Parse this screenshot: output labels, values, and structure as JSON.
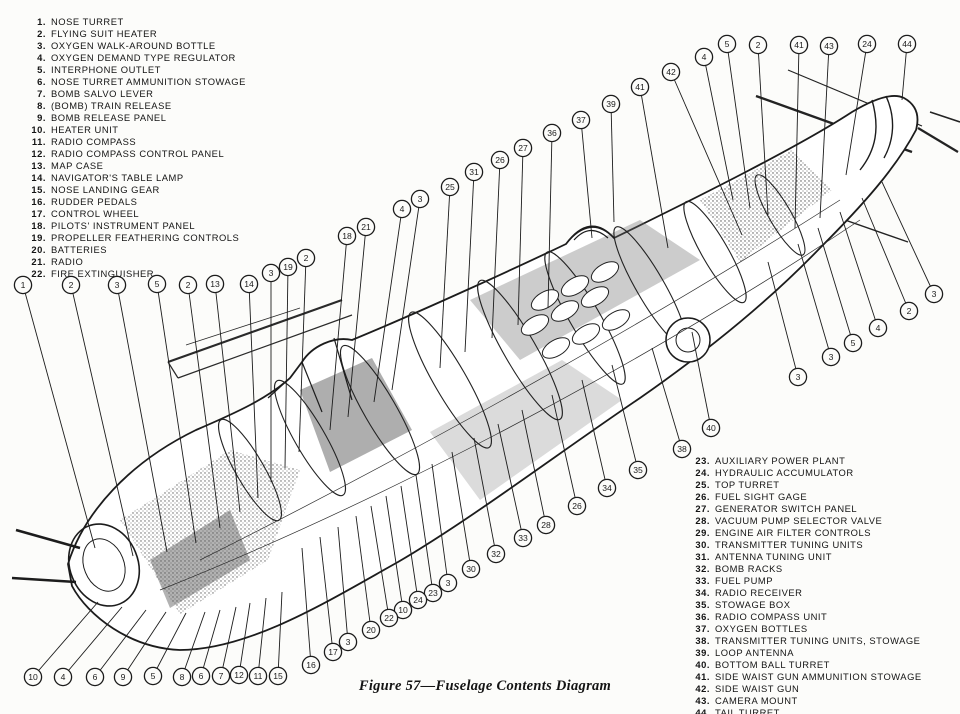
{
  "figure": {
    "caption": "Figure 57—Fuselage Contents Diagram"
  },
  "colors": {
    "ink": "#1c1c1c",
    "paper": "#fcfcfa",
    "shade": "#5d5d5d"
  },
  "legend_left": [
    {
      "num": "1.",
      "label": "NOSE TURRET"
    },
    {
      "num": "2.",
      "label": "FLYING SUIT HEATER"
    },
    {
      "num": "3.",
      "label": "OXYGEN WALK-AROUND BOTTLE"
    },
    {
      "num": "4.",
      "label": "OXYGEN DEMAND TYPE REGULATOR"
    },
    {
      "num": "5.",
      "label": "INTERPHONE OUTLET"
    },
    {
      "num": "6.",
      "label": "NOSE TURRET AMMUNITION STOWAGE"
    },
    {
      "num": "7.",
      "label": "BOMB SALVO LEVER"
    },
    {
      "num": "8.",
      "label": "(BOMB) TRAIN RELEASE"
    },
    {
      "num": "9.",
      "label": "BOMB RELEASE PANEL"
    },
    {
      "num": "10.",
      "label": "HEATER UNIT"
    },
    {
      "num": "11.",
      "label": "RADIO COMPASS"
    },
    {
      "num": "12.",
      "label": "RADIO COMPASS CONTROL PANEL"
    },
    {
      "num": "13.",
      "label": "MAP CASE"
    },
    {
      "num": "14.",
      "label": "NAVIGATOR'S TABLE LAMP"
    },
    {
      "num": "15.",
      "label": "NOSE LANDING GEAR"
    },
    {
      "num": "16.",
      "label": "RUDDER PEDALS"
    },
    {
      "num": "17.",
      "label": "CONTROL WHEEL"
    },
    {
      "num": "18.",
      "label": "PILOTS' INSTRUMENT PANEL"
    },
    {
      "num": "19.",
      "label": "PROPELLER FEATHERING CONTROLS"
    },
    {
      "num": "20.",
      "label": "BATTERIES"
    },
    {
      "num": "21.",
      "label": "RADIO"
    },
    {
      "num": "22.",
      "label": "FIRE EXTINGUISHER"
    }
  ],
  "legend_right": [
    {
      "num": "23.",
      "label": "AUXILIARY POWER PLANT"
    },
    {
      "num": "24.",
      "label": "HYDRAULIC ACCUMULATOR"
    },
    {
      "num": "25.",
      "label": "TOP TURRET"
    },
    {
      "num": "26.",
      "label": "FUEL SIGHT GAGE"
    },
    {
      "num": "27.",
      "label": "GENERATOR SWITCH PANEL"
    },
    {
      "num": "28.",
      "label": "VACUUM PUMP SELECTOR VALVE"
    },
    {
      "num": "29.",
      "label": "ENGINE AIR FILTER CONTROLS"
    },
    {
      "num": "30.",
      "label": "TRANSMITTER TUNING UNITS"
    },
    {
      "num": "31.",
      "label": "ANTENNA TUNING UNIT"
    },
    {
      "num": "32.",
      "label": "BOMB RACKS"
    },
    {
      "num": "33.",
      "label": "FUEL PUMP"
    },
    {
      "num": "34.",
      "label": "RADIO RECEIVER"
    },
    {
      "num": "35.",
      "label": "STOWAGE BOX"
    },
    {
      "num": "36.",
      "label": "RADIO COMPASS UNIT"
    },
    {
      "num": "37.",
      "label": "OXYGEN BOTTLES"
    },
    {
      "num": "38.",
      "label": "TRANSMITTER TUNING UNITS, STOWAGE"
    },
    {
      "num": "39.",
      "label": "LOOP ANTENNA"
    },
    {
      "num": "40.",
      "label": "BOTTOM BALL TURRET"
    },
    {
      "num": "41.",
      "label": "SIDE WAIST GUN AMMUNITION STOWAGE"
    },
    {
      "num": "42.",
      "label": "SIDE WAIST GUN"
    },
    {
      "num": "43.",
      "label": "CAMERA MOUNT"
    },
    {
      "num": "44.",
      "label": "TAIL TURRET"
    }
  ],
  "callouts": [
    {
      "n": "1",
      "x": 23,
      "y": 285,
      "tx": 95,
      "ty": 548
    },
    {
      "n": "2",
      "x": 71,
      "y": 285,
      "tx": 133,
      "ty": 556
    },
    {
      "n": "3",
      "x": 117,
      "y": 285,
      "tx": 167,
      "ty": 552
    },
    {
      "n": "5",
      "x": 157,
      "y": 284,
      "tx": 196,
      "ty": 543
    },
    {
      "n": "2",
      "x": 188,
      "y": 285,
      "tx": 220,
      "ty": 528
    },
    {
      "n": "13",
      "x": 215,
      "y": 284,
      "tx": 240,
      "ty": 512
    },
    {
      "n": "14",
      "x": 249,
      "y": 284,
      "tx": 258,
      "ty": 498
    },
    {
      "n": "3",
      "x": 271,
      "y": 273,
      "tx": 271,
      "ty": 482
    },
    {
      "n": "19",
      "x": 288,
      "y": 267,
      "tx": 285,
      "ty": 468
    },
    {
      "n": "2",
      "x": 306,
      "y": 258,
      "tx": 299,
      "ty": 452
    },
    {
      "n": "18",
      "x": 347,
      "y": 236,
      "tx": 330,
      "ty": 430
    },
    {
      "n": "21",
      "x": 366,
      "y": 227,
      "tx": 348,
      "ty": 417
    },
    {
      "n": "4",
      "x": 402,
      "y": 209,
      "tx": 374,
      "ty": 402
    },
    {
      "n": "3",
      "x": 420,
      "y": 199,
      "tx": 392,
      "ty": 390
    },
    {
      "n": "25",
      "x": 450,
      "y": 187,
      "tx": 440,
      "ty": 368
    },
    {
      "n": "31",
      "x": 474,
      "y": 172,
      "tx": 465,
      "ty": 352
    },
    {
      "n": "26",
      "x": 500,
      "y": 160,
      "tx": 492,
      "ty": 338
    },
    {
      "n": "27",
      "x": 523,
      "y": 148,
      "tx": 518,
      "ty": 325
    },
    {
      "n": "36",
      "x": 552,
      "y": 133,
      "tx": 548,
      "ty": 308
    },
    {
      "n": "37",
      "x": 581,
      "y": 120,
      "tx": 592,
      "ty": 238
    },
    {
      "n": "39",
      "x": 611,
      "y": 104,
      "tx": 614,
      "ty": 222
    },
    {
      "n": "41",
      "x": 640,
      "y": 87,
      "tx": 668,
      "ty": 248
    },
    {
      "n": "42",
      "x": 671,
      "y": 72,
      "tx": 742,
      "ty": 235
    },
    {
      "n": "4",
      "x": 704,
      "y": 57,
      "tx": 733,
      "ty": 200
    },
    {
      "n": "5",
      "x": 727,
      "y": 44,
      "tx": 750,
      "ty": 208
    },
    {
      "n": "2",
      "x": 758,
      "y": 45,
      "tx": 768,
      "ty": 215
    },
    {
      "n": "41",
      "x": 799,
      "y": 45,
      "tx": 795,
      "ty": 228
    },
    {
      "n": "43",
      "x": 829,
      "y": 46,
      "tx": 820,
      "ty": 218
    },
    {
      "n": "24",
      "x": 867,
      "y": 44,
      "tx": 846,
      "ty": 175
    },
    {
      "n": "44",
      "x": 907,
      "y": 44,
      "tx": 902,
      "ty": 100
    },
    {
      "n": "3",
      "x": 934,
      "y": 294,
      "tx": 882,
      "ty": 182
    },
    {
      "n": "2",
      "x": 909,
      "y": 311,
      "tx": 862,
      "ty": 198
    },
    {
      "n": "4",
      "x": 878,
      "y": 328,
      "tx": 840,
      "ty": 212
    },
    {
      "n": "5",
      "x": 853,
      "y": 343,
      "tx": 818,
      "ty": 228
    },
    {
      "n": "3",
      "x": 831,
      "y": 357,
      "tx": 798,
      "ty": 244
    },
    {
      "n": "3",
      "x": 798,
      "y": 377,
      "tx": 768,
      "ty": 262
    },
    {
      "n": "40",
      "x": 711,
      "y": 428,
      "tx": 692,
      "ty": 332
    },
    {
      "n": "38",
      "x": 682,
      "y": 449,
      "tx": 652,
      "ty": 348
    },
    {
      "n": "35",
      "x": 638,
      "y": 470,
      "tx": 612,
      "ty": 365
    },
    {
      "n": "34",
      "x": 607,
      "y": 488,
      "tx": 582,
      "ty": 380
    },
    {
      "n": "26",
      "x": 577,
      "y": 506,
      "tx": 552,
      "ty": 395
    },
    {
      "n": "28",
      "x": 546,
      "y": 525,
      "tx": 522,
      "ty": 410
    },
    {
      "n": "33",
      "x": 523,
      "y": 538,
      "tx": 498,
      "ty": 424
    },
    {
      "n": "32",
      "x": 496,
      "y": 554,
      "tx": 474,
      "ty": 438
    },
    {
      "n": "30",
      "x": 471,
      "y": 569,
      "tx": 452,
      "ty": 452
    },
    {
      "n": "3",
      "x": 448,
      "y": 583,
      "tx": 432,
      "ty": 464
    },
    {
      "n": "23",
      "x": 433,
      "y": 593,
      "tx": 416,
      "ty": 475
    },
    {
      "n": "24",
      "x": 418,
      "y": 600,
      "tx": 401,
      "ty": 486
    },
    {
      "n": "10",
      "x": 403,
      "y": 610,
      "tx": 386,
      "ty": 496
    },
    {
      "n": "22",
      "x": 389,
      "y": 618,
      "tx": 371,
      "ty": 506
    },
    {
      "n": "20",
      "x": 371,
      "y": 630,
      "tx": 356,
      "ty": 516
    },
    {
      "n": "3",
      "x": 348,
      "y": 642,
      "tx": 338,
      "ty": 527
    },
    {
      "n": "17",
      "x": 333,
      "y": 652,
      "tx": 320,
      "ty": 537
    },
    {
      "n": "16",
      "x": 311,
      "y": 665,
      "tx": 302,
      "ty": 548
    },
    {
      "n": "10",
      "x": 33,
      "y": 677,
      "tx": 98,
      "ty": 602
    },
    {
      "n": "4",
      "x": 63,
      "y": 677,
      "tx": 122,
      "ty": 607
    },
    {
      "n": "6",
      "x": 95,
      "y": 677,
      "tx": 146,
      "ty": 610
    },
    {
      "n": "9",
      "x": 123,
      "y": 677,
      "tx": 166,
      "ty": 612
    },
    {
      "n": "5",
      "x": 153,
      "y": 676,
      "tx": 186,
      "ty": 613
    },
    {
      "n": "8",
      "x": 182,
      "y": 677,
      "tx": 205,
      "ty": 612
    },
    {
      "n": "6",
      "x": 201,
      "y": 676,
      "tx": 220,
      "ty": 610
    },
    {
      "n": "7",
      "x": 221,
      "y": 676,
      "tx": 236,
      "ty": 607
    },
    {
      "n": "12",
      "x": 239,
      "y": 675,
      "tx": 250,
      "ty": 603
    },
    {
      "n": "11",
      "x": 258,
      "y": 676,
      "tx": 266,
      "ty": 598
    },
    {
      "n": "15",
      "x": 278,
      "y": 676,
      "tx": 282,
      "ty": 592
    }
  ]
}
